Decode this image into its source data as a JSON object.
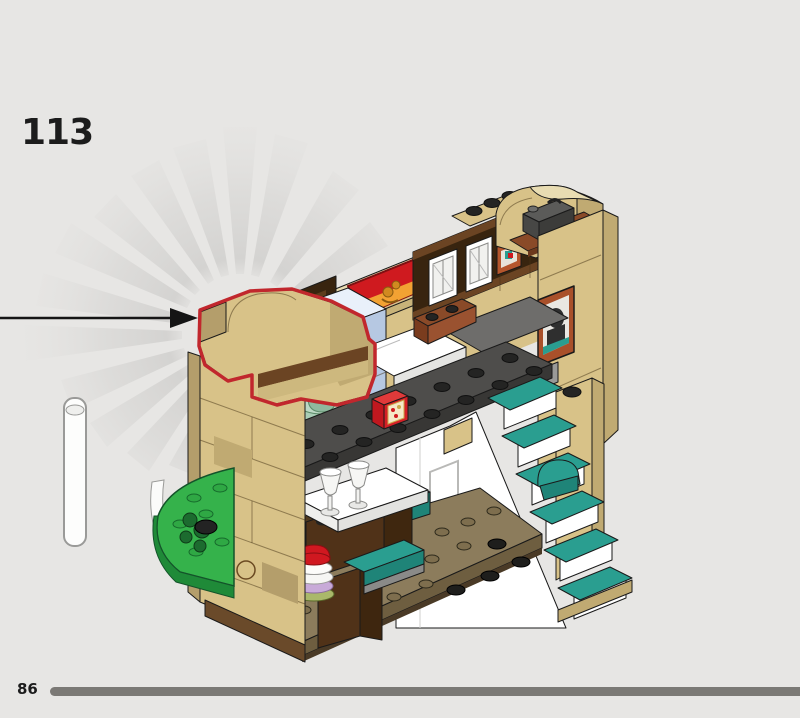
{
  "page": {
    "step_number": "113",
    "footer": {
      "page_number": "86"
    },
    "progress_percent": 100
  },
  "theme": {
    "background": "#e7e6e4",
    "text": "#1c1c1c",
    "progress_bar": "#7b7975",
    "highlight_red": "#c1272d",
    "arrow_black": "#151515",
    "ray_gray": "#cfcecc",
    "tan": "#d8c288",
    "tan_dark": "#c0aa72",
    "tan_deep": "#b49e6b",
    "tan_light": "#e8dcb2",
    "brown": "#8a4a28",
    "reddish_brown": "#9b4f28",
    "dark_brown": "#503218",
    "wainscot_brown": "#38240f",
    "teal": "#2a9e90",
    "teal_dark": "#1f8478",
    "light_blue": "#cddef2",
    "light_blue_dark": "#b6c8e2",
    "light_blue_top": "#e9f0fa",
    "green": "#35b24b",
    "green_dark": "#1f8a38",
    "sand_green": "#a9cdb6",
    "banner_red": "#cf1a1f",
    "banner_orange": "#f2a233",
    "plate_gray": "#4e4d4b",
    "stud_black": "#242423",
    "floor_olive": "#8c7c5c",
    "white": "#ffffff"
  },
  "model": {
    "name": "lego-house-interior-model",
    "highlighted_part": "tan-arch-wall-section",
    "callout": "new-part-arrow",
    "parts": [
      "starburst-rays",
      "street-lamp",
      "back-wall",
      "gryffindor-banner",
      "wainscot-windows",
      "framed-picture-small",
      "arch-tower-top",
      "dark-case",
      "right-wall",
      "portrait-frame",
      "blue-column",
      "bed",
      "rug",
      "desk",
      "sand-green-bowl",
      "upper-floor-plate",
      "red-trunk",
      "cupboard-under-stairs",
      "teal-staircase",
      "teal-armchair",
      "newel-post",
      "ground-floor-plate",
      "dining-table",
      "goblets",
      "teal-bench",
      "plate-stack",
      "cabinet",
      "green-baseplate",
      "plants"
    ]
  }
}
